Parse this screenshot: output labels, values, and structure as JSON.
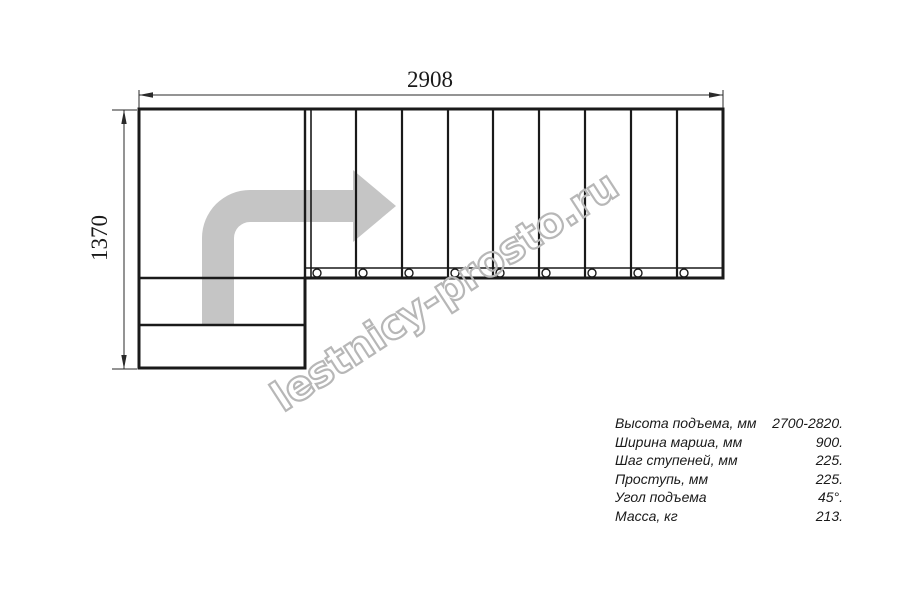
{
  "drawing": {
    "title": "staircase-plan-top-view",
    "top_dimension_mm": "2908",
    "left_dimension_mm": "1370",
    "tread_count_straight_flight": 9,
    "colors": {
      "line": "#1a1a1a",
      "arrow_fill": "#c5c5c5",
      "watermark_stroke": "#b7b7b7",
      "background": "#ffffff"
    }
  },
  "watermark": {
    "text": "lestnicy-prosto.ru"
  },
  "specs": {
    "rows": [
      {
        "label": "Высота подъема, мм",
        "value": "2700-2820."
      },
      {
        "label": "Ширина марша, мм",
        "value": "900."
      },
      {
        "label": "Шаг ступеней, мм",
        "value": "225."
      },
      {
        "label": "Проступь, мм",
        "value": "225."
      },
      {
        "label": "Угол подъема",
        "value": "45°."
      },
      {
        "label": "Масса, кг",
        "value": "213."
      }
    ]
  }
}
